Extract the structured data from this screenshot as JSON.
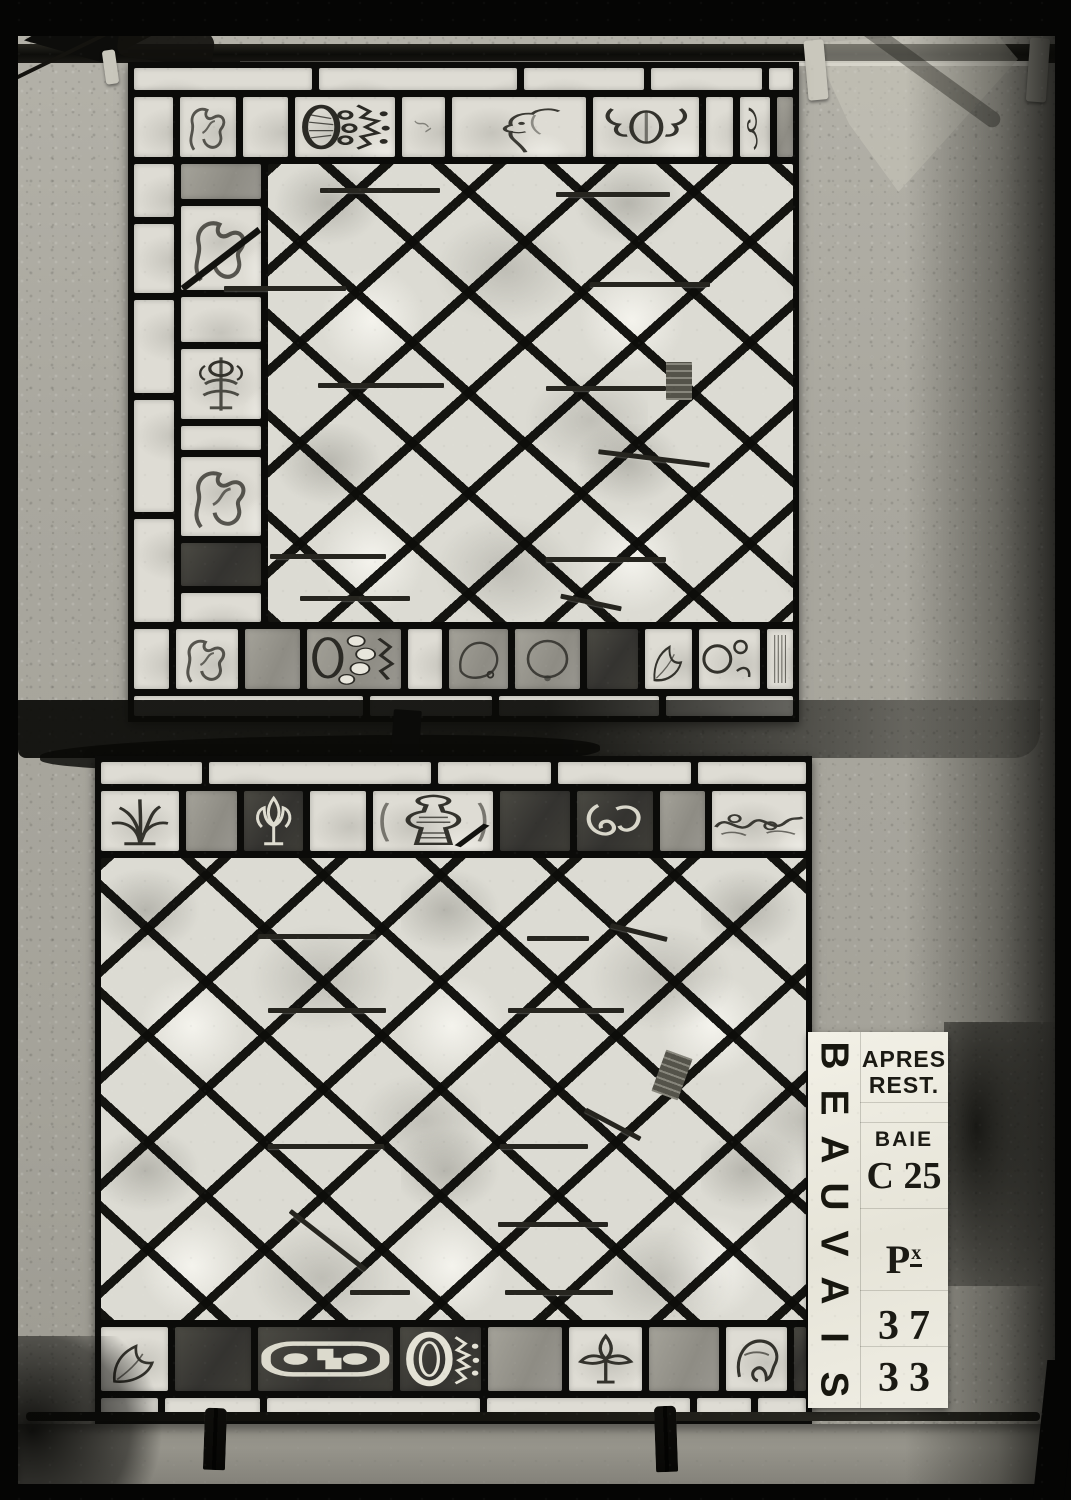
{
  "colors": {
    "film_black": "#050504",
    "board_gray": "#a9a79e",
    "lead_black": "#0c0c0a",
    "glass_light": "#dcdbd3",
    "card_white": "#efede3",
    "ink_black": "#1b1a14"
  },
  "scene": {
    "description": "Archival black-and-white photograph of two leaded diamond-lattice stained-glass panels with ornamental border pieces, hung from a dark rod on a textured board, with a restoration label card at lower right",
    "clothespins_count": 2
  },
  "label_plate": {
    "side_text": "BEAUVAIS",
    "side_letters": [
      "B",
      "E",
      "A",
      "U",
      "V",
      "A",
      "I",
      "S"
    ],
    "line_apres": "APRES",
    "line_rest": "REST.",
    "line_baie": "BAIE",
    "line_bay_number": "C 25",
    "line_panel_letter": "P",
    "line_panel_sup": "x",
    "number_top": "37",
    "number_bottom": "33"
  },
  "panels": {
    "top": {
      "top_strip": [
        {
          "type": "strip",
          "w": 185
        },
        {
          "type": "strip",
          "w": 205
        },
        {
          "type": "strip",
          "w": 125
        },
        {
          "type": "strip",
          "w": 115
        },
        {
          "type": "strip",
          "w": 25
        }
      ],
      "top_border": [
        {
          "type": "strip",
          "w": 40
        },
        {
          "type": "acanthus",
          "w": 58
        },
        {
          "type": "strip",
          "w": 46
        },
        {
          "type": "crown-side",
          "w": 104
        },
        {
          "type": "plain-sketch",
          "w": 44
        },
        {
          "type": "face-profile",
          "w": 138
        },
        {
          "type": "baluster-scroll",
          "w": 110
        },
        {
          "type": "strip",
          "w": 28
        },
        {
          "type": "corner-scroll",
          "w": 30
        },
        {
          "type": "gray",
          "w": 17
        }
      ],
      "left_strip": [
        {
          "type": "strip",
          "w": 62
        },
        {
          "type": "strip",
          "w": 80
        },
        {
          "type": "strip",
          "w": 108
        },
        {
          "type": "strip",
          "w": 130
        },
        {
          "type": "strip",
          "w": 120
        }
      ],
      "left_col": [
        {
          "type": "gray",
          "w": 44
        },
        {
          "type": "acanthus-diag",
          "w": 106
        },
        {
          "type": "strip",
          "w": 56
        },
        {
          "type": "candelabra",
          "w": 88
        },
        {
          "type": "strip",
          "w": 30
        },
        {
          "type": "acanthus",
          "w": 100
        },
        {
          "type": "dark",
          "w": 54
        },
        {
          "type": "strip",
          "w": 36
        }
      ],
      "bottom_border": [
        {
          "type": "strip",
          "w": 36
        },
        {
          "type": "acanthus",
          "w": 62
        },
        {
          "type": "gray",
          "w": 56
        },
        {
          "type": "crown-side2",
          "w": 96
        },
        {
          "type": "strip",
          "w": 34
        },
        {
          "type": "blob-gray",
          "w": 60
        },
        {
          "type": "round-gray",
          "w": 66
        },
        {
          "type": "dark",
          "w": 52
        },
        {
          "type": "leaf-light",
          "w": 48
        },
        {
          "type": "scroll-circles",
          "w": 62
        },
        {
          "type": "column-frag",
          "w": 26
        }
      ],
      "bottom_strip": [
        {
          "type": "strip",
          "w": 235
        },
        {
          "type": "strip",
          "w": 125
        },
        {
          "type": "strip",
          "w": 165
        },
        {
          "type": "strip",
          "w": 130
        }
      ],
      "bars": [
        [
          192,
          126,
          120,
          0
        ],
        [
          428,
          130,
          114,
          0
        ],
        [
          96,
          224,
          122,
          0
        ],
        [
          462,
          220,
          120,
          0
        ],
        [
          190,
          321,
          126,
          0
        ],
        [
          418,
          324,
          120,
          0
        ],
        [
          470,
          394,
          112,
          7
        ],
        [
          142,
          492,
          116,
          0
        ],
        [
          418,
          495,
          120,
          0
        ],
        [
          172,
          534,
          110,
          0
        ],
        [
          432,
          538,
          62,
          12
        ]
      ]
    },
    "bottom": {
      "top_strip": [
        {
          "type": "strip",
          "w": 105
        },
        {
          "type": "strip",
          "w": 230
        },
        {
          "type": "strip",
          "w": 118
        },
        {
          "type": "strip",
          "w": 138
        },
        {
          "type": "strip",
          "w": 112
        }
      ],
      "top_border": [
        {
          "type": "palmette",
          "w": 76
        },
        {
          "type": "gray",
          "w": 50
        },
        {
          "type": "fleur-scroll",
          "w": 58
        },
        {
          "type": "strip",
          "w": 54
        },
        {
          "type": "baluster",
          "w": 118
        },
        {
          "type": "dark",
          "w": 68
        },
        {
          "type": "scroll-leaf",
          "w": 74
        },
        {
          "type": "gray",
          "w": 44
        },
        {
          "type": "floral-band",
          "w": 92
        }
      ],
      "bottom_border": [
        {
          "type": "leaf-light",
          "w": 66
        },
        {
          "type": "dark",
          "w": 74
        },
        {
          "type": "buckle",
          "w": 132
        },
        {
          "type": "ring-crown",
          "w": 80
        },
        {
          "type": "gray",
          "w": 72
        },
        {
          "type": "fleur-leaf",
          "w": 72
        },
        {
          "type": "gray",
          "w": 68
        },
        {
          "type": "helmet",
          "w": 60
        },
        {
          "type": "darker",
          "w": 12
        }
      ],
      "bottom_strip": [
        {
          "type": "strip",
          "w": 58
        },
        {
          "type": "strip",
          "w": 95
        },
        {
          "type": "strip",
          "w": 215
        },
        {
          "type": "strip",
          "w": 205
        },
        {
          "type": "strip",
          "w": 55
        },
        {
          "type": "strip",
          "w": 48
        }
      ],
      "bars": [
        [
          163,
          178,
          118,
          0
        ],
        [
          432,
          180,
          62,
          0
        ],
        [
          515,
          174,
          58,
          14
        ],
        [
          173,
          252,
          118,
          0
        ],
        [
          413,
          252,
          116,
          0
        ],
        [
          173,
          388,
          116,
          0
        ],
        [
          405,
          388,
          88,
          0
        ],
        [
          487,
          366,
          62,
          28
        ],
        [
          185,
          482,
          96,
          38
        ],
        [
          403,
          466,
          110,
          0
        ],
        [
          255,
          534,
          60,
          0
        ],
        [
          410,
          534,
          108,
          0
        ]
      ]
    }
  }
}
